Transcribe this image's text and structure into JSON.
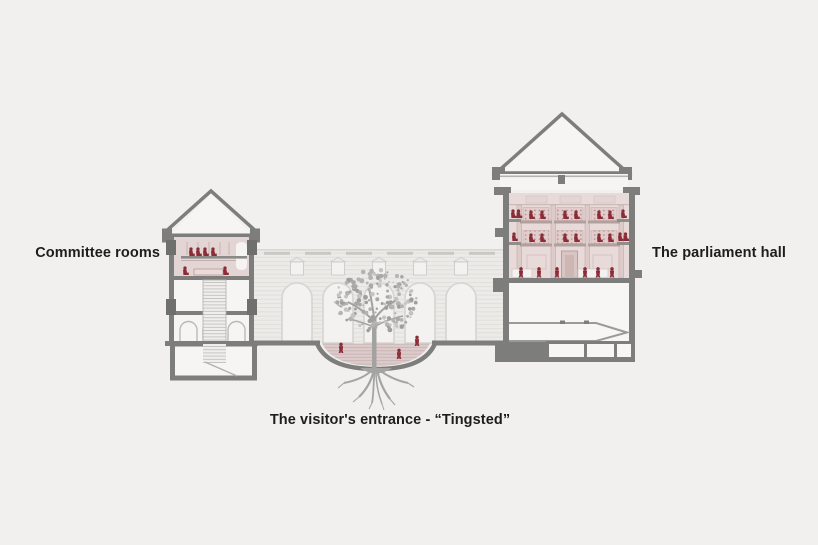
{
  "diagram": {
    "kind": "architectural-cross-section",
    "labels": {
      "committee_rooms": "Committee rooms",
      "parliament_hall": "The parliament hall",
      "visitors_entrance": "The visitor's entrance - “Tingsted”"
    },
    "colors": {
      "background": "#f1f0ee",
      "structure_gray": "#7d7d7b",
      "facade_light": "#ecebe8",
      "parliament_interior_pink": "#e8dad8",
      "committee_interior_pink": "#e3d5d3",
      "seating_pink": "#e1cdcc",
      "figure_red": "#8b2c37",
      "tree_gray": "#a8a8a6",
      "label_text": "#1d1d1b"
    },
    "elements": [
      "committee-rooms-tower",
      "arched-courtyard-facade",
      "visitors-entrance-bowl",
      "tree-with-roots",
      "parliament-hall-building",
      "people-figures"
    ]
  }
}
